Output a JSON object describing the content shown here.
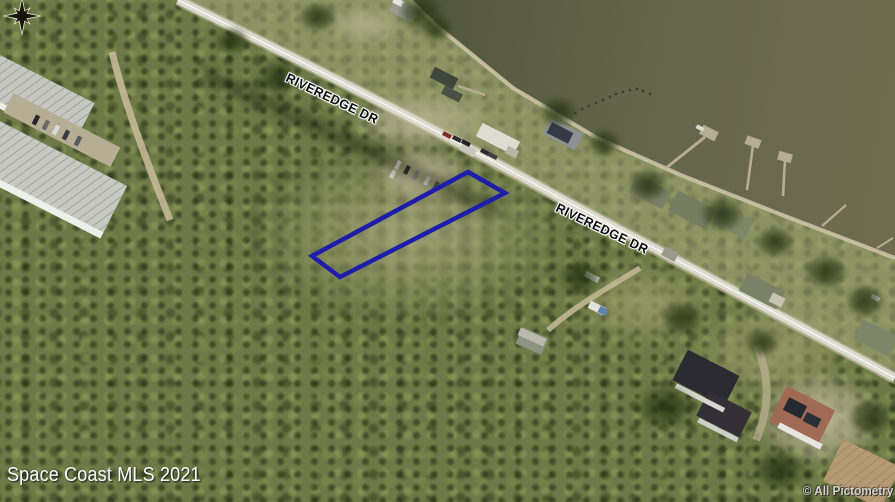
{
  "map": {
    "road_labels": [
      {
        "text": "RIVEREDGE DR"
      },
      {
        "text": "RIVEREDGE DR"
      }
    ],
    "watermark": "Space Coast MLS 2021",
    "copyright": "© All Pictometry",
    "parcel_outline_color": "#1d1daa",
    "icons": {
      "compass": "compass-rose-icon"
    },
    "colors": {
      "water": "#60604a",
      "forest": "#6d7946",
      "road": "#dcdacf",
      "shore_sand": "#cdc3a6"
    }
  }
}
